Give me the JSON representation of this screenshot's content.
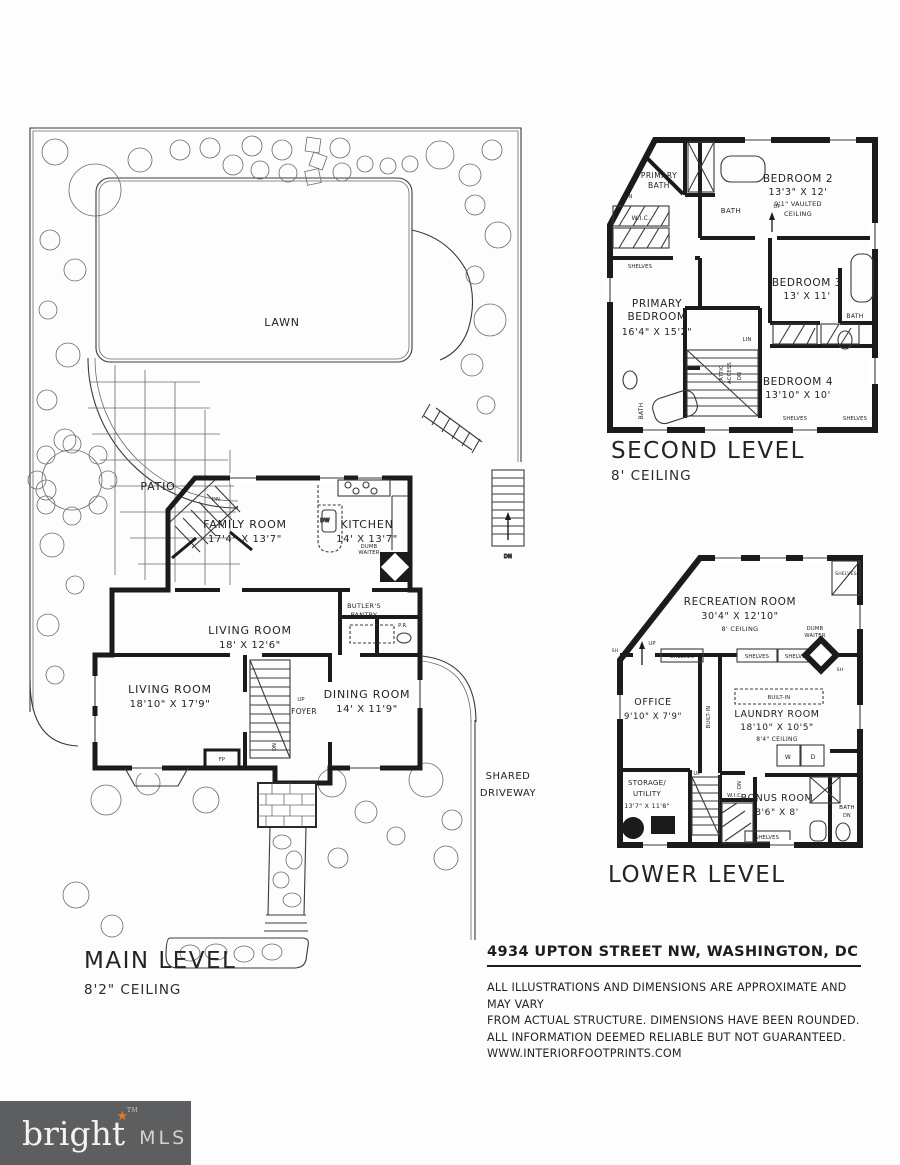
{
  "captions": {
    "main": {
      "title": "MAIN LEVEL",
      "ceiling": "8'2\" CEILING"
    },
    "second": {
      "title": "SECOND LEVEL",
      "ceiling": "8' CEILING"
    },
    "lower": {
      "title": "LOWER LEVEL"
    }
  },
  "site": {
    "lawn": "LAWN",
    "patio": "PATIO",
    "driveway1": "SHARED",
    "driveway2": "DRIVEWAY"
  },
  "ann": {
    "up": "UP",
    "dn": "DN",
    "lin": "LIN",
    "wic": "W.I.C.",
    "bath": "BATH",
    "shelves": "SHELVES",
    "fp": "FP",
    "dw": "DW",
    "pr": "P.R.",
    "sh": "SH",
    "w": "W",
    "d": "D",
    "dumb": "DUMB",
    "waiter": "WAITER",
    "attic": "ATTIC",
    "access": "ACCESS",
    "builtin": "BUILT-IN",
    "butlers": "BUTLER'S",
    "pantry": "PANTRY"
  },
  "rooms": {
    "family": {
      "name": "FAMILY ROOM",
      "dims": "17'4\" X 13'7\""
    },
    "kitchen": {
      "name": "KITCHEN",
      "dims": "14' X 13'7\""
    },
    "living_upper": {
      "name": "LIVING ROOM",
      "dims": "18' X 12'6\""
    },
    "living": {
      "name": "LIVING ROOM",
      "dims": "18'10\" X 17'9\""
    },
    "dining": {
      "name": "DINING ROOM",
      "dims": "14' X 11'9\""
    },
    "foyer": {
      "name": "FOYER"
    },
    "primary_bath": {
      "name1": "PRIMARY",
      "name2": "BATH"
    },
    "primary_bed": {
      "name1": "PRIMARY",
      "name2": "BEDROOM",
      "dims": "16'4\" X 15'2\""
    },
    "bedroom2": {
      "name": "BEDROOM 2",
      "dims": "13'3\" X 12'",
      "note1": "9'1\" VAULTED",
      "note2": "CEILING"
    },
    "bedroom3": {
      "name": "BEDROOM 3",
      "dims": "13' X 11'"
    },
    "bedroom4": {
      "name": "BEDROOM 4",
      "dims": "13'10\" X 10'"
    },
    "recreation": {
      "name": "RECREATION ROOM",
      "dims": "30'4\" X 12'10\"",
      "note": "8' CEILING"
    },
    "office": {
      "name": "OFFICE",
      "dims": "9'10\" X 7'9\""
    },
    "laundry": {
      "name": "LAUNDRY ROOM",
      "dims": "18'10\" X 10'5\"",
      "note": "8'4\" CEILING"
    },
    "bonus": {
      "name": "BONUS ROOM",
      "dims": "8'6\" X 8'"
    },
    "storage": {
      "name1": "STORAGE/",
      "name2": "UTILITY",
      "dims": "13'7\" X 11'8\""
    }
  },
  "footer": {
    "address": "4934 UPTON STREET NW, WASHINGTON, DC",
    "disclaimer": [
      "ALL ILLUSTRATIONS AND DIMENSIONS ARE APPROXIMATE AND MAY VARY",
      "FROM ACTUAL STRUCTURE. DIMENSIONS HAVE BEEN ROUNDED.",
      "ALL INFORMATION DEEMED RELIABLE BUT NOT GUARANTEED.",
      "WWW.INTERIORFOOTPRINTS.COM"
    ]
  },
  "logo": {
    "brand": "bright",
    "mls": "MLS",
    "tm": "TM"
  }
}
